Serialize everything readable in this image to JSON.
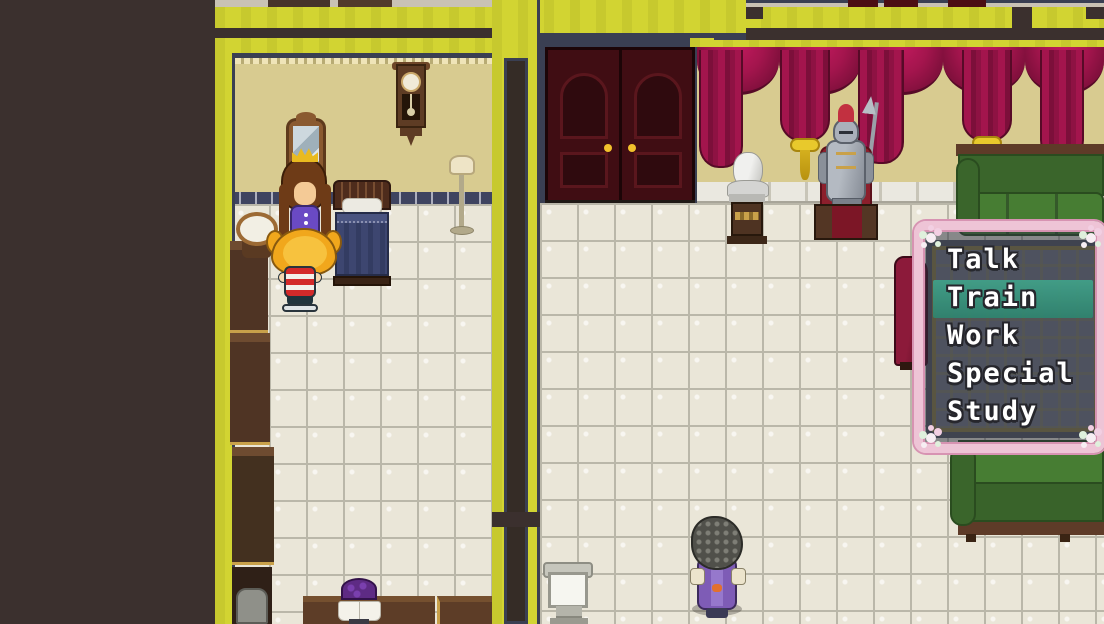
{
  "window": {
    "kind": "rpg-command-menu"
  },
  "menu": {
    "items": [
      {
        "label": "Talk"
      },
      {
        "label": "Train"
      },
      {
        "label": "Work"
      },
      {
        "label": "Special"
      },
      {
        "label": "Study"
      }
    ],
    "selected_index": 1,
    "selected_label": "Train"
  },
  "colors": {
    "selection_highlight": "#3ca189",
    "menu_border_pink": "#eec4d6",
    "menu_background": "rgba(44,50,66,0.52)",
    "wall_top_yellow": "#d2d432",
    "curtain_crimson": "#a3154d",
    "bedroom_wall_tan": "#d8cb90",
    "floor_tile": "#eae6d8",
    "void_brown": "#3b302e"
  }
}
